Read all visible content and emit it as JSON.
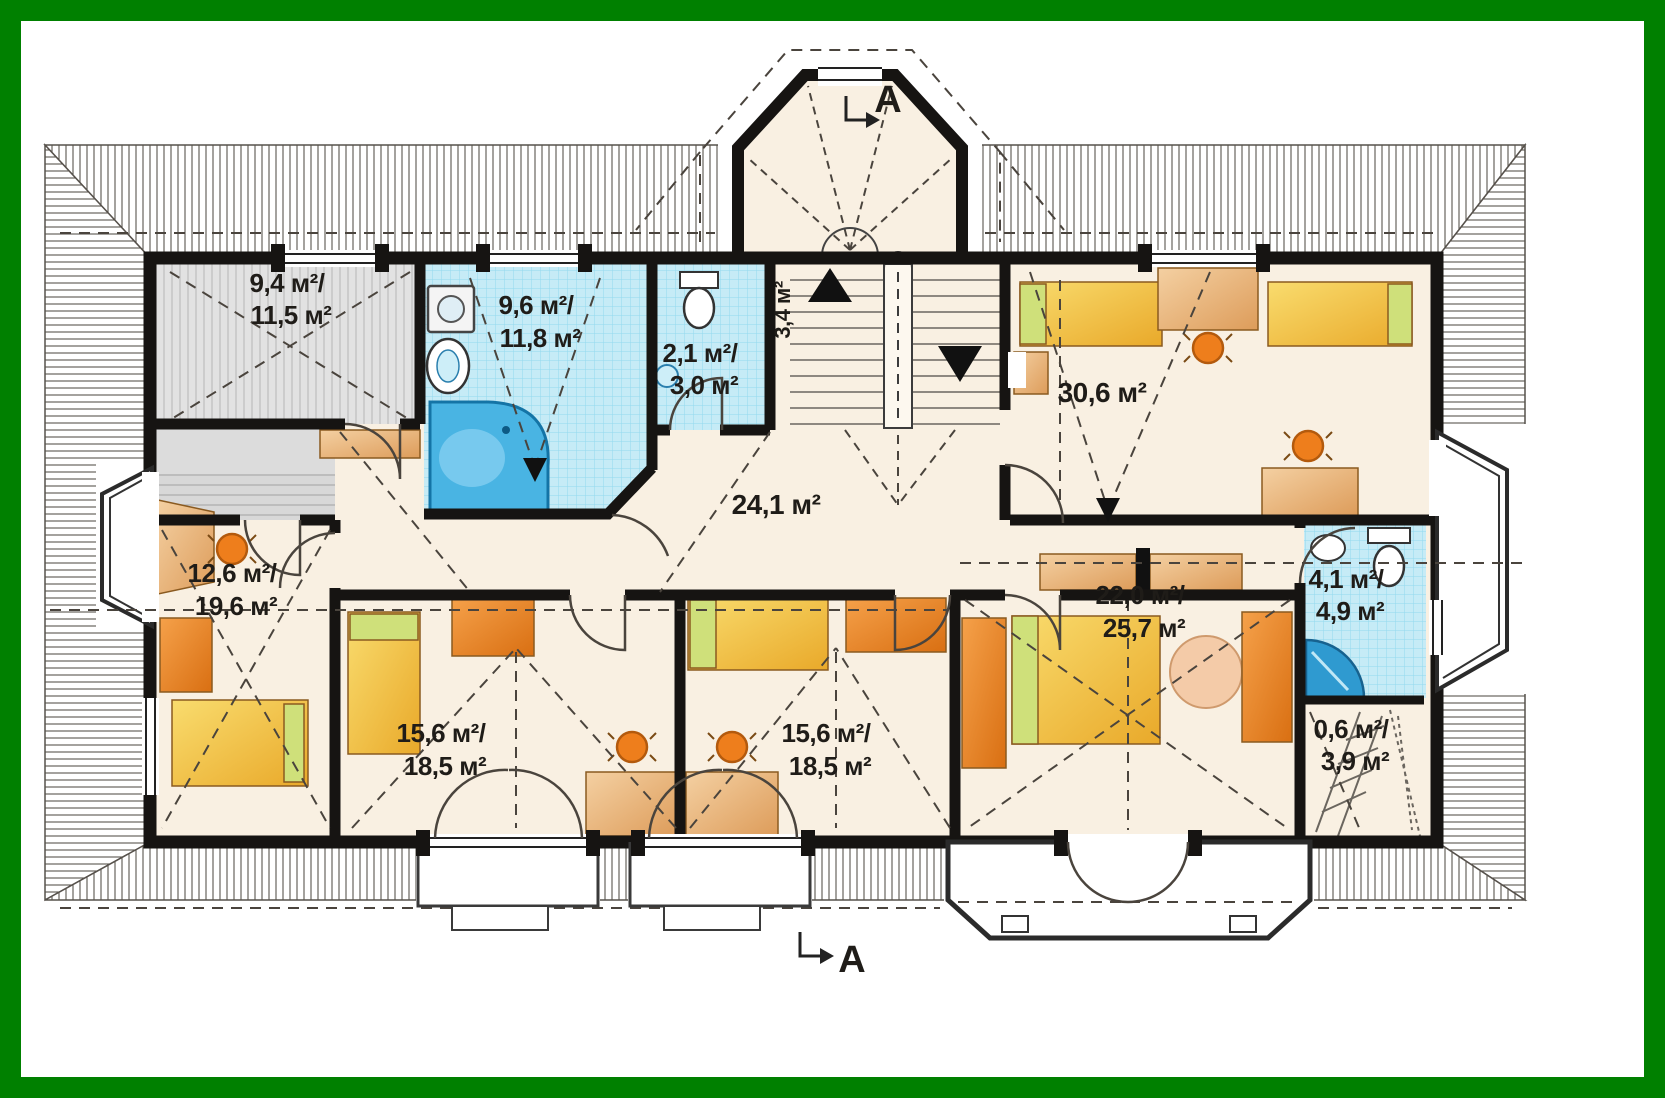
{
  "plan": {
    "title": "attic-floor-plan",
    "unit": "м²",
    "rooms": {
      "storage_top_left": {
        "line1": "9,4 м²/",
        "line2": "11,5 м²"
      },
      "bathroom_main": {
        "line1": "9,6 м²/",
        "line2": "11,8 м²"
      },
      "wc": {
        "line1": "2,1 м²/",
        "line2": "3,0 м²"
      },
      "stair_hall": {
        "line1": "3,4 м²"
      },
      "bedroom_right": {
        "line1": "30,6 м²"
      },
      "hall": {
        "line1": "24,1 м²"
      },
      "bedroom_left": {
        "line1": "12,6 м²/",
        "line2": "19,6 м²"
      },
      "bedroom_bottom_1": {
        "line1": "15,6 м²/",
        "line2": "18,5 м²"
      },
      "bedroom_bottom_2": {
        "line1": "15,6 м²/",
        "line2": "18,5 м²"
      },
      "bedroom_master": {
        "line1": "22,0 м²/",
        "line2": "25,7 м²"
      },
      "bathroom_small": {
        "line1": "4,1 м²/",
        "line2": "4,9 м²"
      },
      "storage_small": {
        "line1": "0,6 м²/",
        "line2": "3,9 м²"
      }
    },
    "section_markers": {
      "top": "A",
      "bottom": "A"
    },
    "colors": {
      "frame_green": "#008000",
      "wall_black": "#161412",
      "floor_cream": "#f9f0e2",
      "tile_blue": "#c6ebf6",
      "water_blue": "#49b4e3",
      "furniture_orange": "#ee7e1c",
      "bed_yellow": "#eeb335",
      "pillow_green": "#cfe07a",
      "gray_floor": "#e0e0e0",
      "roof_hatch": "#5a554e"
    }
  }
}
